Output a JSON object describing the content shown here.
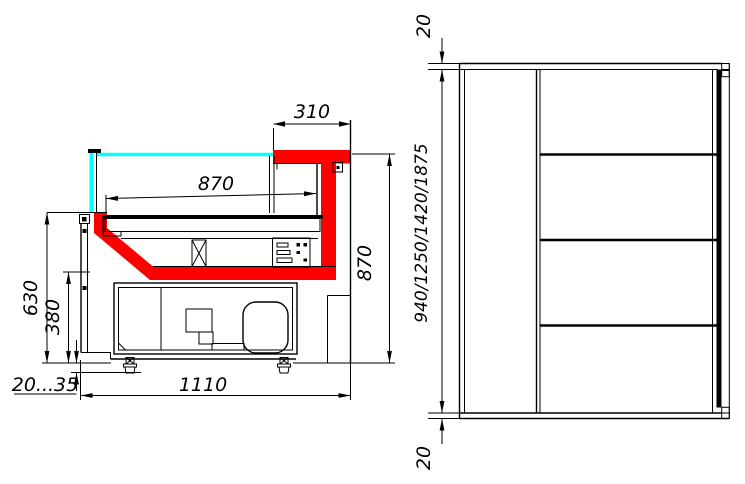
{
  "drawing": {
    "side_view": {
      "dimensions": {
        "canopy_depth": "310",
        "display_depth": "870",
        "display_height": "870",
        "front_panel_height": "630",
        "base_section_height": "380",
        "leg_adjust_range": "20...35",
        "total_depth": "1110"
      }
    },
    "front_view": {
      "dimensions": {
        "top_offset": "20",
        "height_variants": "940/1250/1420/1875",
        "bottom_offset": "20"
      }
    },
    "colors": {
      "highlight_red": "#FF0000",
      "glass_cyan": "#00FFFF",
      "line_black": "#000000",
      "background": "#FFFFFF"
    }
  }
}
